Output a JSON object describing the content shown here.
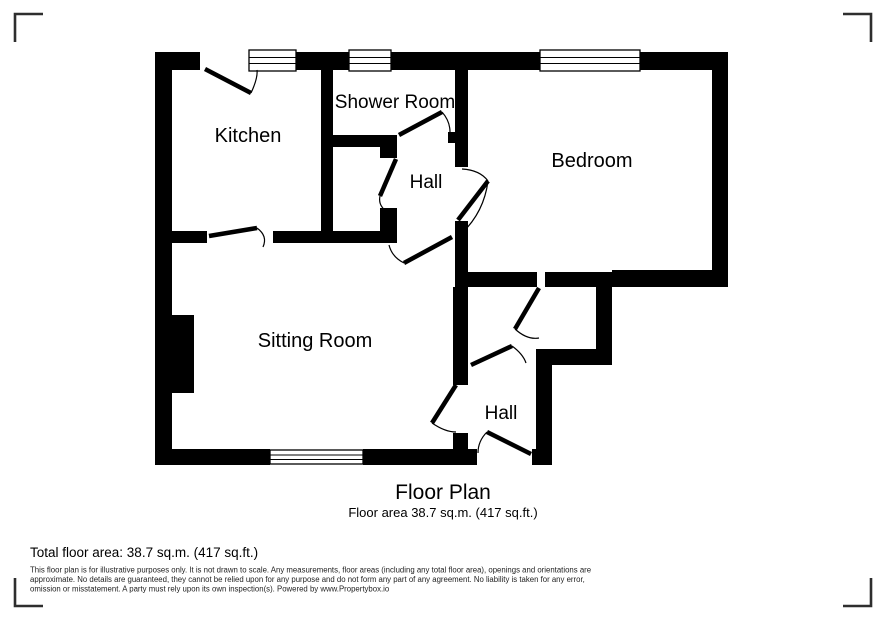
{
  "plan": {
    "rooms": [
      {
        "label": "Kitchen"
      },
      {
        "label": "Shower Room"
      },
      {
        "label": "Hall"
      },
      {
        "label": "Bedroom"
      },
      {
        "label": "Sitting Room"
      },
      {
        "label": "Hall"
      }
    ],
    "caption": {
      "title": "Floor Plan",
      "area": "Floor area 38.7 sq.m. (417 sq.ft.)"
    }
  },
  "footer": {
    "total_area": "Total floor area: 38.7 sq.m. (417 sq.ft.)",
    "disclaimer": {
      "line1": "This floor plan is for illustrative purposes only. It is not drawn to scale. Any measurements, floor areas (including any total floor area), openings and orientations are",
      "line2": "approximate. No details are guaranteed, they cannot be relied upon for any purpose and do not form any part of any agreement. No liability is taken for any error,",
      "line3": "omission or misstatement. A party must rely upon its own inspection(s). Powered by www.Propertybox.io"
    }
  },
  "colors": {
    "wall": "#000000",
    "background": "#ffffff",
    "corner_mark": "#2e2e2e",
    "text": "#000000",
    "disclaimer_text": "#1f1f1f"
  }
}
